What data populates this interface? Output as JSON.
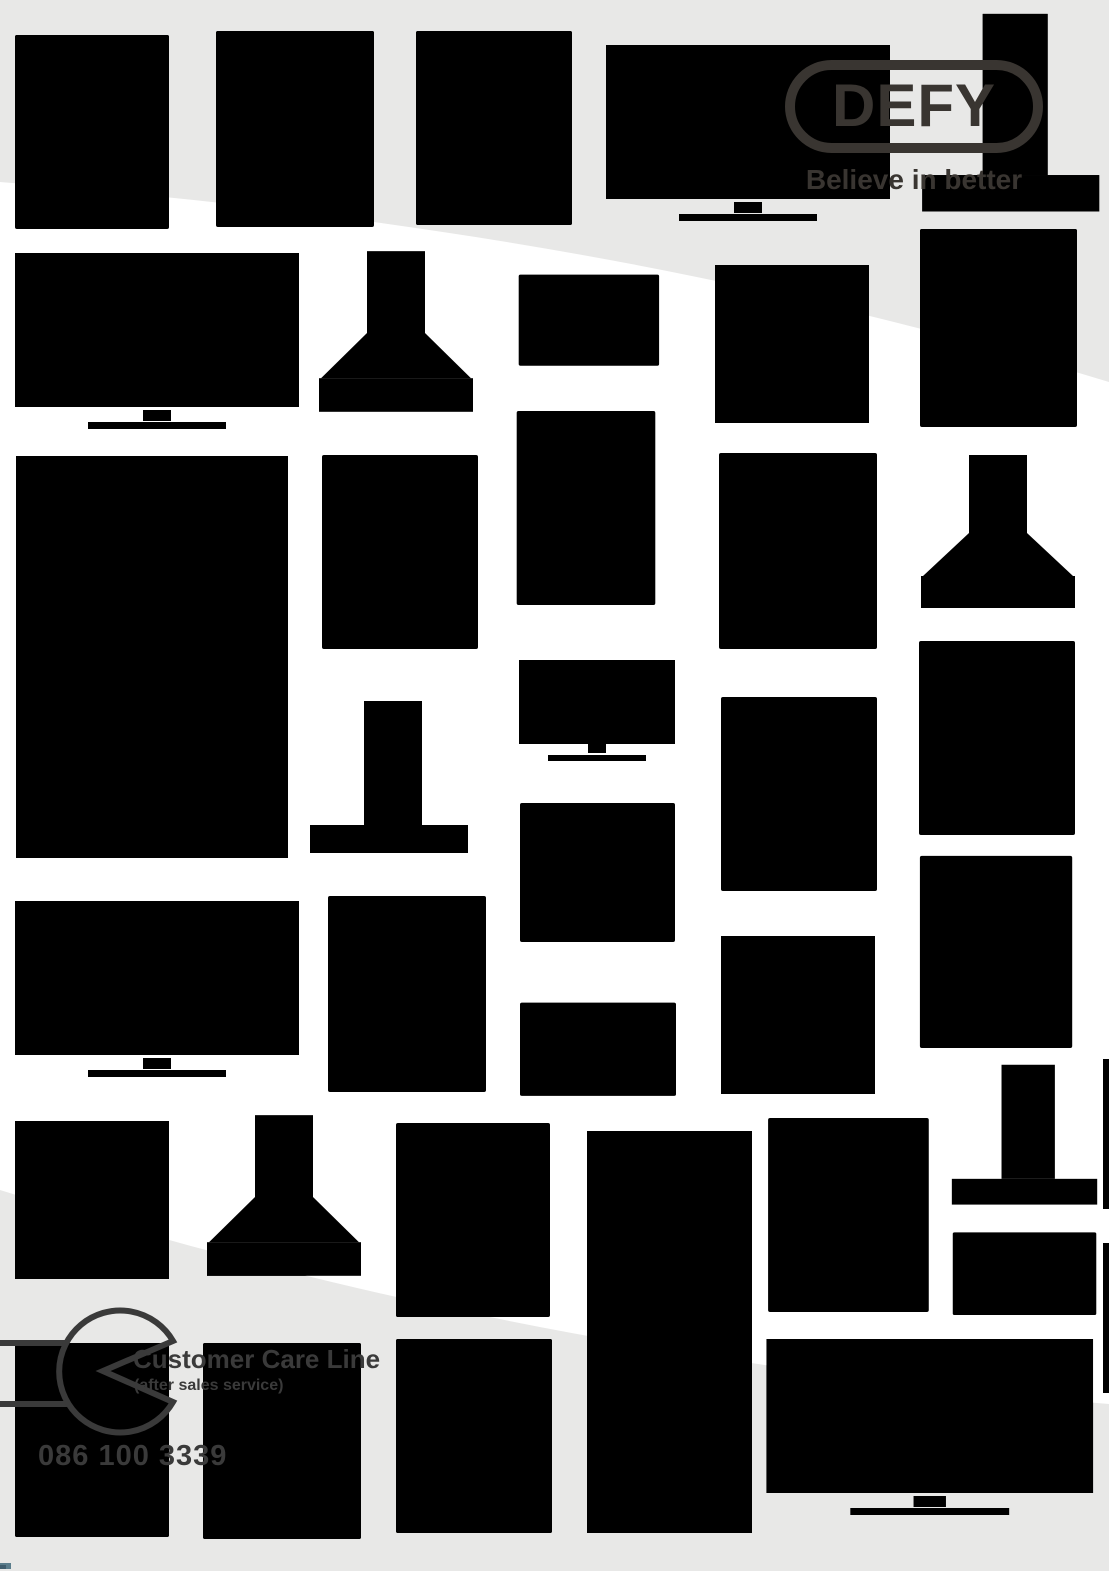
{
  "logo": {
    "text": "DEFY",
    "tagline": "Believe in better"
  },
  "customer_care": {
    "title": "Customer Care Line",
    "subtitle": "(after sales service)",
    "phone": "086 100 3339"
  },
  "icons": {
    "wrench": "wrench-icon",
    "background_appliances": [
      "oven",
      "stove",
      "dishwasher",
      "washing-machine",
      "tumble-dryer",
      "tv",
      "cooker-hood",
      "microwave",
      "hob",
      "fridge-side-by-side",
      "fridge-top-freezer"
    ]
  },
  "colors": {
    "page_background": "#ffffff",
    "swoosh_gray": "#e8e8e7",
    "pattern_stroke": "#ebebea",
    "pattern_stroke_on_gray": "#f4f4f3",
    "dark": "#393531",
    "wrench": "#3a3a3a",
    "corner_artifact": "#5a7d8c"
  }
}
